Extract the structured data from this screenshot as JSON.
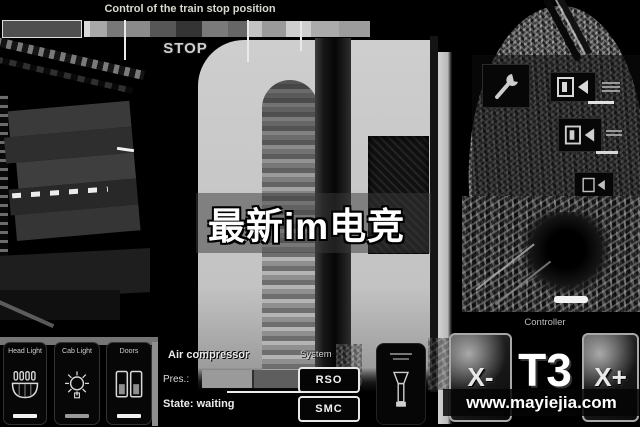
{
  "window": {
    "width": 640,
    "height": 427
  },
  "colors": {
    "background": "#000000",
    "wall_gray": "#c9c9c9",
    "button_bg": "#070707",
    "button_border_light": "#e8e8e8",
    "indicator_on": "#f2f2f2",
    "indicator_off": "#9a9a9a"
  },
  "icons": {
    "headlight": "headlight-icon",
    "cab_light": "bulb-icon",
    "doors": "double-door-icon",
    "maintenance": "wrench-icon",
    "door_indicator": "door-arrow-icon",
    "emergency_handle": "brake-handle-icon"
  },
  "top_gauge": {
    "title": "Control of the train stop position",
    "stop_label": "STOP",
    "segments": [
      {
        "w": 78,
        "c": "#4f4f4f"
      },
      {
        "w": 6,
        "c": "#d8d8d8"
      },
      {
        "w": 17,
        "c": "#a8a8a8"
      },
      {
        "w": 18,
        "c": "#787878"
      },
      {
        "w": 25,
        "c": "#8a8a8a"
      },
      {
        "w": 26,
        "c": "#565656"
      },
      {
        "w": 26,
        "c": "#343434"
      },
      {
        "w": 26,
        "c": "#7a7a7a"
      },
      {
        "w": 19,
        "c": "#666666"
      },
      {
        "w": 15,
        "c": "#c2c2c2"
      },
      {
        "w": 24,
        "c": "#9a9a9a"
      },
      {
        "w": 25,
        "c": "#cecece"
      },
      {
        "w": 28,
        "c": "#ababab"
      },
      {
        "w": 31,
        "c": "#9c9c9c"
      }
    ]
  },
  "hud": {
    "left_buttons": [
      {
        "label": "Head Light",
        "indicator_color": "#f2f2f2"
      },
      {
        "label": "Cab Light",
        "indicator_color": "#9a9a9a"
      },
      {
        "label": "Doors",
        "indicator_color": "#f2f2f2"
      }
    ],
    "air_compressor": {
      "title": "Air compressor",
      "pressure_label": "Pres.:",
      "state": "State: waiting"
    },
    "system": {
      "title": "System",
      "buttons": [
        "RSO",
        "SMC"
      ]
    },
    "controller": {
      "title": "Controller",
      "decrease": "X-",
      "notch": "T3",
      "increase": "X+"
    }
  },
  "watermarks": {
    "center": "最新im电竞",
    "site": "www.mayiejia.com"
  }
}
